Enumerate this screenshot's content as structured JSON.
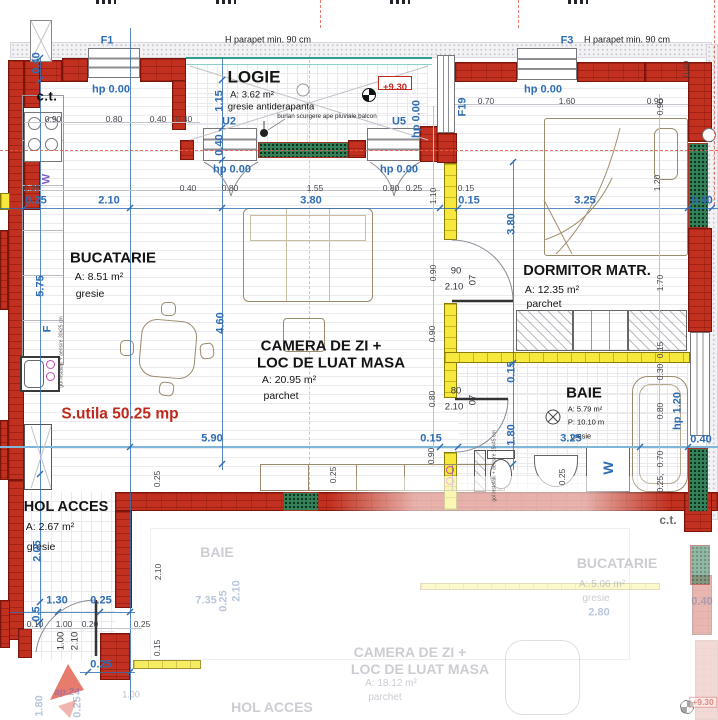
{
  "title": "apartment floor plan ap.24",
  "colors": {
    "wall_red": "#c2311f",
    "partition_yellow": "#f6e83c",
    "dimension_blue": "#2e6db4",
    "railing_teal": "#2e9e8f",
    "green_pad": "#35815a",
    "usable_area_red": "#c0281c"
  },
  "rooms": {
    "logie": {
      "name": "LOGIE",
      "area": "A: 3.62 m²",
      "floor": "gresie antiderapanta"
    },
    "bucatarie": {
      "name": "BUCATARIE",
      "area": "A: 8.51 m²",
      "floor": "gresie"
    },
    "camera": {
      "name_line1": "CAMERA DE ZI  +",
      "name_line2": "LOC DE LUAT MASA",
      "area": "A: 20.95 m²",
      "floor": "parchet"
    },
    "dormitor": {
      "name": "DORMITOR MATR.",
      "area": "A: 12.35 m²",
      "floor": "parchet"
    },
    "baie": {
      "name": "BAIE",
      "area": "A: 5.79 m²",
      "perimeter": "P: 10.10 m",
      "floor": "gresie"
    },
    "hol": {
      "name": "HOL ACCES",
      "area": "A: 2.67 m²",
      "floor": "gresie"
    }
  },
  "annotations": {
    "usable_area": "S.utila 50.25 mp",
    "elevation": "+9.30",
    "boiler": "c.t."
  },
  "labels": [
    {
      "t": "0.25",
      "x": 36,
      "y": 201,
      "c": "blue"
    },
    {
      "t": "2.10",
      "x": 109,
      "y": 201,
      "c": "blue"
    },
    {
      "t": "3.80",
      "x": 311,
      "y": 201,
      "c": "blue"
    },
    {
      "t": "0.15",
      "x": 469,
      "y": 201,
      "c": "blue"
    },
    {
      "t": "3.25",
      "x": 585,
      "y": 201,
      "c": "blue"
    },
    {
      "t": "0.40",
      "x": 702,
      "y": 201,
      "c": "blue"
    },
    {
      "t": "5.90",
      "x": 212,
      "y": 439,
      "c": "blue"
    },
    {
      "t": "0.15",
      "x": 431,
      "y": 439,
      "c": "blue"
    },
    {
      "t": "3.25",
      "x": 571,
      "y": 439,
      "c": "blue"
    },
    {
      "t": "0.40",
      "x": 701,
      "y": 440,
      "c": "blue"
    },
    {
      "t": "1.30",
      "x": 57,
      "y": 601,
      "c": "blue"
    },
    {
      "t": "0.25",
      "x": 101,
      "y": 601,
      "c": "blue"
    },
    {
      "t": "0.25",
      "x": 101,
      "y": 665,
      "c": "blue"
    },
    {
      "t": "0.40",
      "x": 37,
      "y": 63,
      "c": "blue",
      "r": 1
    },
    {
      "t": "5.75",
      "x": 41,
      "y": 286,
      "c": "blue",
      "r": 1
    },
    {
      "t": "2.05",
      "x": 38,
      "y": 551,
      "c": "blue",
      "r": 1
    },
    {
      "t": "0.5",
      "x": 37,
      "y": 614,
      "c": "blue",
      "r": 1
    },
    {
      "t": "1.15",
      "x": 220,
      "y": 101,
      "c": "blue",
      "r": 1
    },
    {
      "t": "0.40",
      "x": 220,
      "y": 145,
      "c": "blue",
      "r": 1
    },
    {
      "t": "4.60",
      "x": 221,
      "y": 323,
      "c": "blue",
      "r": 1
    },
    {
      "t": "3.80",
      "x": 512,
      "y": 224,
      "c": "blue",
      "r": 1
    },
    {
      "t": "0.15",
      "x": 512,
      "y": 372,
      "c": "blue",
      "r": 1
    },
    {
      "t": "1.80",
      "x": 512,
      "y": 435,
      "c": "blue",
      "r": 1
    },
    {
      "t": "hp 1.20",
      "x": 678,
      "y": 411,
      "c": "blue",
      "r": 1
    },
    {
      "t": "F19",
      "x": 463,
      "y": 107,
      "c": "blue",
      "r": 1
    },
    {
      "t": "F1",
      "x": 107,
      "y": 41,
      "c": "blue"
    },
    {
      "t": "F3",
      "x": 567,
      "y": 41,
      "c": "blue"
    },
    {
      "t": "U2",
      "x": 229,
      "y": 122,
      "c": "blue"
    },
    {
      "t": "U5",
      "x": 399,
      "y": 122,
      "c": "blue"
    },
    {
      "t": "hp 0.00",
      "x": 111,
      "y": 90,
      "c": "blue"
    },
    {
      "t": "hp 0.00",
      "x": 232,
      "y": 170,
      "c": "blue"
    },
    {
      "t": "hp 0.00",
      "x": 399,
      "y": 170,
      "c": "blue"
    },
    {
      "t": "hp 0.00",
      "x": 543,
      "y": 90,
      "c": "blue"
    },
    {
      "t": "hp 0.00",
      "x": 417,
      "y": 119,
      "c": "blue",
      "r": 1
    },
    {
      "t": "W",
      "x": 47,
      "y": 179,
      "c": "purple",
      "r": 1
    },
    {
      "t": "F",
      "x": 48,
      "y": 329,
      "c": "blue",
      "r": 1
    },
    {
      "t": "W",
      "x": 608,
      "y": 468,
      "c": "wmach",
      "r": 1
    },
    {
      "t": "0.90",
      "x": 53,
      "y": 119,
      "c": "g"
    },
    {
      "t": "0.80",
      "x": 114,
      "y": 119,
      "c": "g"
    },
    {
      "t": "0.40",
      "x": 158,
      "y": 119,
      "c": "g"
    },
    {
      "t": "0.40",
      "x": 184,
      "y": 119,
      "c": "g"
    },
    {
      "t": "0.25",
      "x": 32,
      "y": 188,
      "c": "g"
    },
    {
      "t": "0.40",
      "x": 188,
      "y": 188,
      "c": "g"
    },
    {
      "t": "0.80",
      "x": 230,
      "y": 188,
      "c": "g"
    },
    {
      "t": "1.55",
      "x": 315,
      "y": 188,
      "c": "g"
    },
    {
      "t": "0.80",
      "x": 391,
      "y": 188,
      "c": "g"
    },
    {
      "t": "0.25",
      "x": 414,
      "y": 188,
      "c": "g"
    },
    {
      "t": "0.15",
      "x": 466,
      "y": 188,
      "c": "g"
    },
    {
      "t": "0.70",
      "x": 486,
      "y": 101,
      "c": "g"
    },
    {
      "t": "1.60",
      "x": 567,
      "y": 101,
      "c": "g"
    },
    {
      "t": "0.90",
      "x": 655,
      "y": 101,
      "c": "g"
    },
    {
      "t": "0.40",
      "x": 686,
      "y": 69,
      "c": "g",
      "r": 1
    },
    {
      "t": "0.10",
      "x": 35,
      "y": 624,
      "c": "g"
    },
    {
      "t": "1.00",
      "x": 64,
      "y": 624,
      "c": "g"
    },
    {
      "t": "0.20",
      "x": 90,
      "y": 624,
      "c": "g"
    },
    {
      "t": "0.25",
      "x": 142,
      "y": 624,
      "c": "g"
    },
    {
      "t": "1.10",
      "x": 433,
      "y": 196,
      "c": "g",
      "r": 1
    },
    {
      "t": "0.90",
      "x": 433,
      "y": 273,
      "c": "g",
      "r": 1
    },
    {
      "t": "0.90",
      "x": 432,
      "y": 334,
      "c": "g",
      "r": 1
    },
    {
      "t": "0.80",
      "x": 432,
      "y": 399,
      "c": "g",
      "r": 1
    },
    {
      "t": "0.90",
      "x": 431,
      "y": 456,
      "c": "g",
      "r": 1
    },
    {
      "t": "0.90",
      "x": 660,
      "y": 107,
      "c": "g",
      "r": 1
    },
    {
      "t": "1.20",
      "x": 657,
      "y": 183,
      "c": "g",
      "r": 1
    },
    {
      "t": "1.70",
      "x": 660,
      "y": 283,
      "c": "g",
      "r": 1
    },
    {
      "t": "0.15",
      "x": 660,
      "y": 350,
      "c": "g",
      "r": 1
    },
    {
      "t": "0.30",
      "x": 660,
      "y": 372,
      "c": "g",
      "r": 1
    },
    {
      "t": "0.80",
      "x": 660,
      "y": 411,
      "c": "g",
      "r": 1
    },
    {
      "t": "0.70",
      "x": 660,
      "y": 459,
      "c": "g",
      "r": 1
    },
    {
      "t": "0.25,",
      "x": 660,
      "y": 483,
      "c": "g",
      "r": 1
    },
    {
      "t": "0.25",
      "x": 157,
      "y": 479,
      "c": "g",
      "r": 1
    },
    {
      "t": "0.25",
      "x": 333,
      "y": 475,
      "c": "g",
      "r": 1
    },
    {
      "t": "0.25",
      "x": 562,
      "y": 477,
      "c": "g",
      "r": 1
    },
    {
      "t": "1.00",
      "x": 61,
      "y": 641,
      "c": "gd",
      "r": 1
    },
    {
      "t": "2.10",
      "x": 75,
      "y": 641,
      "c": "gd",
      "r": 1
    },
    {
      "t": "0.15",
      "x": 157,
      "y": 648,
      "c": "g",
      "r": 1
    },
    {
      "t": "2.10",
      "x": 158,
      "y": 572,
      "c": "g",
      "r": 1
    },
    {
      "t": "90",
      "x": 456,
      "y": 271,
      "c": "gd"
    },
    {
      "t": "07",
      "x": 473,
      "y": 280,
      "c": "gd",
      "r": 1
    },
    {
      "t": "2.10",
      "x": 454,
      "y": 287,
      "c": "gd"
    },
    {
      "t": "80",
      "x": 456,
      "y": 391,
      "c": "gd"
    },
    {
      "t": "07",
      "x": 473,
      "y": 400,
      "c": "gd",
      "r": 1
    },
    {
      "t": "2.10",
      "x": 454,
      "y": 407,
      "c": "gd"
    },
    {
      "t": "H parapet min. 90 cm",
      "x": 268,
      "y": 40,
      "c": "k9"
    },
    {
      "t": "H parapet min. 90 cm",
      "x": 627,
      "y": 40,
      "c": "k9"
    },
    {
      "t": "burlan scurgere ape pluviale balcon",
      "x": 327,
      "y": 117,
      "c": "k7"
    },
    {
      "t": "gol instalatii + aerisire 30x25 cm",
      "x": 62,
      "y": 352,
      "c": "tiny",
      "r": 1
    },
    {
      "t": "gol instalatii + aerisire 15x45 cm",
      "x": 495,
      "y": 466,
      "c": "tiny",
      "r": 1
    },
    {
      "t": "BAIE",
      "x": 217,
      "y": 552,
      "c": "froom"
    },
    {
      "t": "7.35",
      "x": 206,
      "y": 601,
      "c": "fblue"
    },
    {
      "t": "2.10",
      "x": 237,
      "y": 591,
      "c": "fblue",
      "r": 1
    },
    {
      "t": "HOL ACCES",
      "x": 272,
      "y": 707,
      "c": "froom"
    },
    {
      "t": "CAMERA DE ZI  +",
      "x": 410,
      "y": 652,
      "c": "froom"
    },
    {
      "t": "LOC DE LUAT MASA",
      "x": 420,
      "y": 669,
      "c": "froom"
    },
    {
      "t": "A: 18.12 m²",
      "x": 391,
      "y": 684,
      "c": "fsub"
    },
    {
      "t": "parchet",
      "x": 385,
      "y": 698,
      "c": "fsub"
    },
    {
      "t": "BUCATARIE",
      "x": 617,
      "y": 563,
      "c": "froom"
    },
    {
      "t": "A: 5.06 m²",
      "x": 602,
      "y": 585,
      "c": "fsub"
    },
    {
      "t": "gresie",
      "x": 596,
      "y": 599,
      "c": "fsub"
    },
    {
      "t": "2.80",
      "x": 599,
      "y": 613,
      "c": "fblue"
    },
    {
      "t": "0.40",
      "x": 702,
      "y": 602,
      "c": "fblue"
    },
    {
      "t": "c.t.",
      "x": 668,
      "y": 520,
      "c": "fct"
    },
    {
      "t": "ap.24",
      "x": 67,
      "y": 693,
      "c": "fblue2"
    },
    {
      "t": "1.00",
      "x": 131,
      "y": 695,
      "c": "fg"
    },
    {
      "t": "1.80",
      "x": 40,
      "y": 706,
      "c": "fblue",
      "r": 1
    },
    {
      "t": "0.25",
      "x": 78,
      "y": 707,
      "c": "fblue",
      "r": 1
    },
    {
      "t": "0.25",
      "x": 224,
      "y": 601,
      "c": "fblue",
      "r": 1
    },
    {
      "t": "+9.30",
      "x": 703,
      "y": 702,
      "c": "fred"
    }
  ]
}
